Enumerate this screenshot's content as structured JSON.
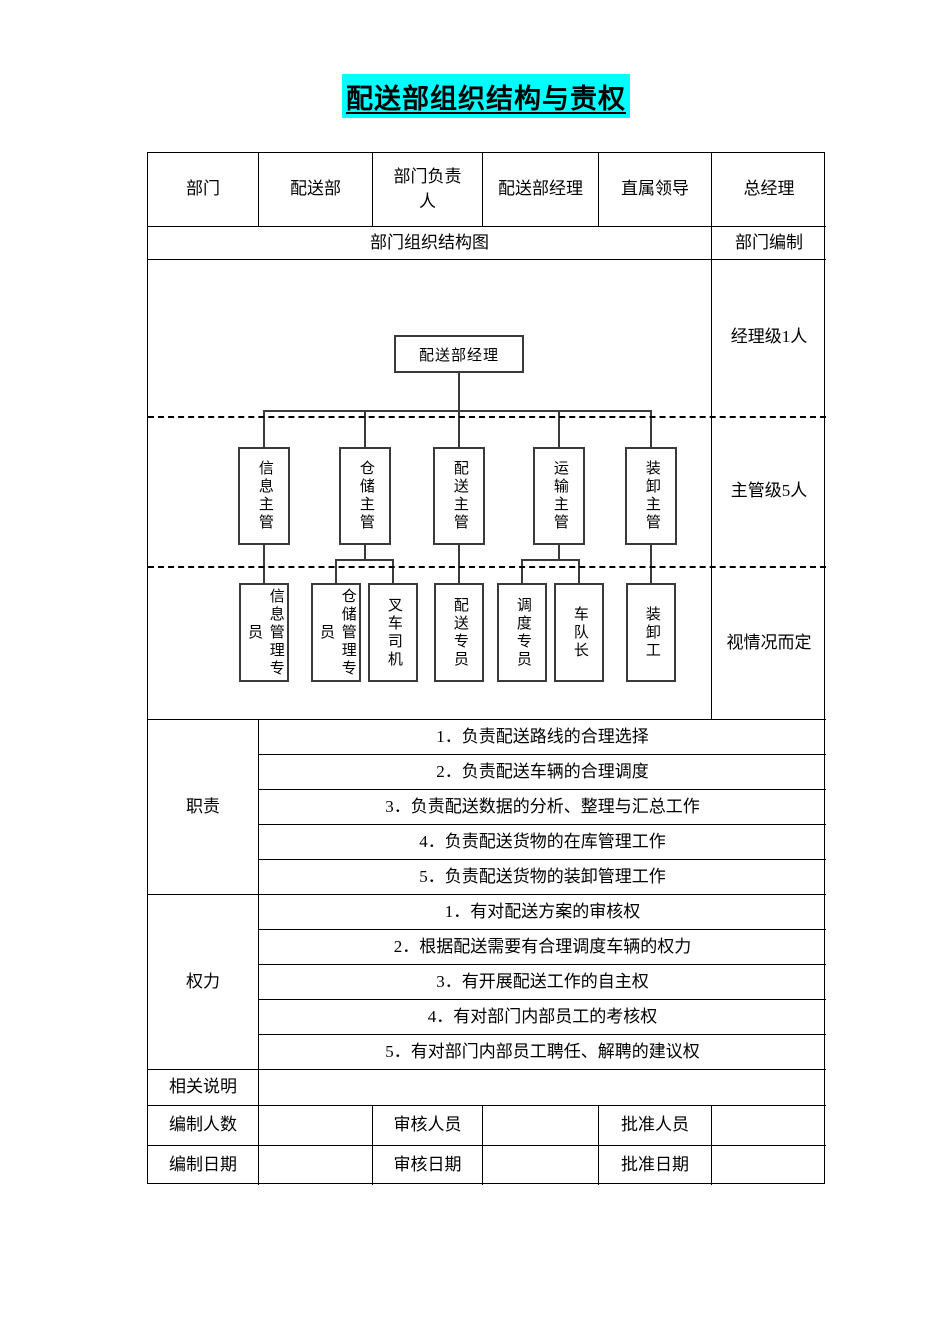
{
  "title": "配送部组织结构与责权",
  "header_row": {
    "dept_label": "部门",
    "dept_value": "配送部",
    "head_label": "部门负责人",
    "head_value": "配送部经理",
    "leader_label": "直属领导",
    "leader_value": "总经理"
  },
  "chart_header": {
    "title": "部门组织结构图",
    "staffing_label": "部门编制"
  },
  "org_chart": {
    "manager": "配送部经理",
    "supervisors": [
      "信息主管",
      "仓储主管",
      "配送主管",
      "运输主管",
      "装卸主管"
    ],
    "staff": [
      "信息管理专\n员",
      "仓储管理专\n员",
      "叉车司机",
      "配送专员",
      "调度专员",
      "车队长",
      "装卸工"
    ],
    "staffing_levels": [
      "经理级1人",
      "主管级5人",
      "视情况而定"
    ]
  },
  "duties": {
    "label": "职责",
    "items": [
      "1．负责配送路线的合理选择",
      "2．负责配送车辆的合理调度",
      "3．负责配送数据的分析、整理与汇总工作",
      "4．负责配送货物的在库管理工作",
      "5．负责配送货物的装卸管理工作"
    ]
  },
  "powers": {
    "label": "权力",
    "items": [
      "1．有对配送方案的审核权",
      "2．根据配送需要有合理调度车辆的权力",
      "3．有开展配送工作的自主权",
      "4．有对部门内部员工的考核权",
      "5．有对部门内部员工聘任、解聘的建议权"
    ]
  },
  "notes": {
    "label": "相关说明",
    "value": ""
  },
  "footer": {
    "row1": {
      "c1": "编制人数",
      "c2": "",
      "c3": "审核人员",
      "c4": "",
      "c5": "批准人员",
      "c6": ""
    },
    "row2": {
      "c1": "编制日期",
      "c2": "",
      "c3": "审核日期",
      "c4": "",
      "c5": "批准日期",
      "c6": ""
    }
  },
  "colors": {
    "title_highlight": "#00ffff",
    "line": "#000000"
  }
}
